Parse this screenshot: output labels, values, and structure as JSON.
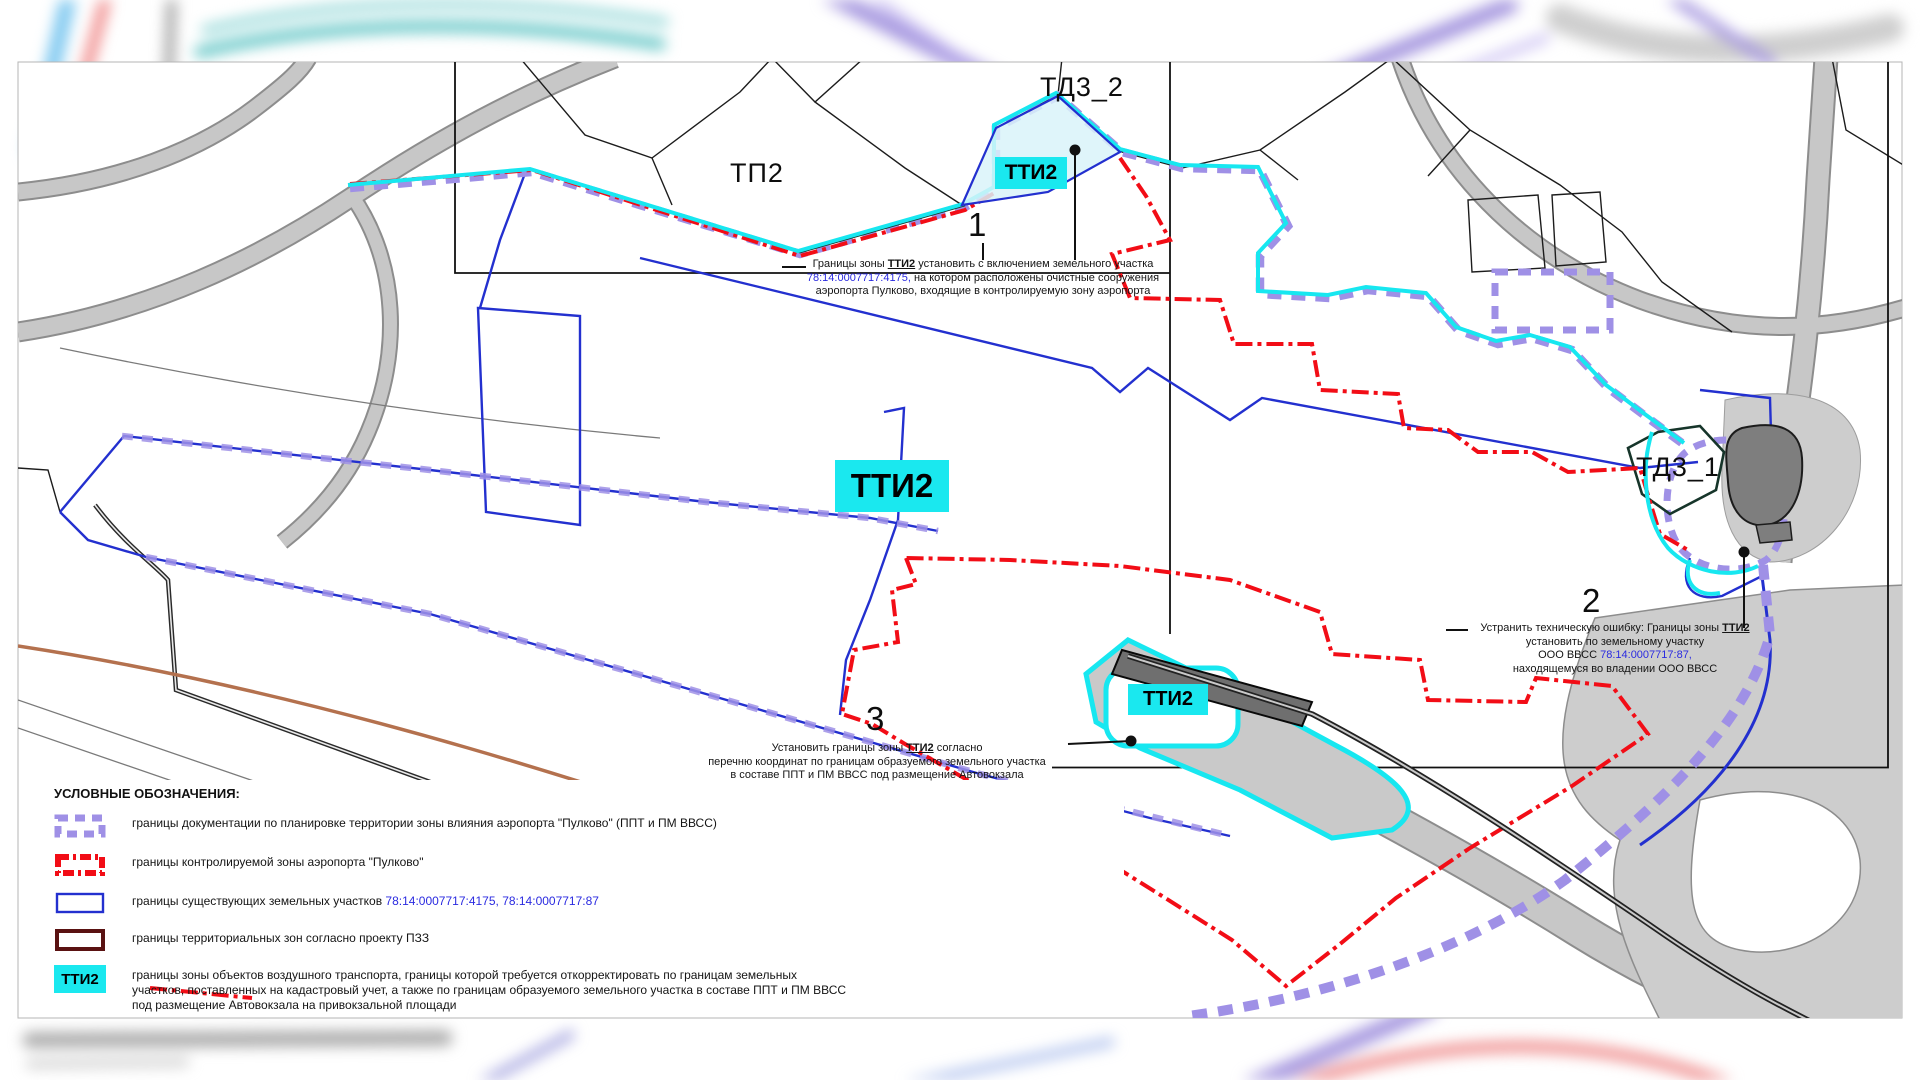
{
  "map": {
    "labels": {
      "td3_2": "ТД3_2",
      "tp2": "ТП2",
      "tti2_top": "ТТИ2",
      "tti2_center": "ТТИ2",
      "tti2_bus": "ТТИ2",
      "td3_1": "ТД3_1"
    },
    "markers": {
      "m1": "1",
      "m2": "2",
      "m3": "3"
    },
    "annotations": {
      "a1": {
        "l1_pre": "Границы зоны ",
        "l1_zone": "ТТИ2",
        "l1_post": " установить с включением земельного участка",
        "l2_num": "78:14:0007717:4175,",
        "l2_post": " на котором расположены очистные сооружения",
        "l3": "аэропорта Пулково, входящие в контролируемую зону аэропорта"
      },
      "a2": {
        "l1_pre": "Устранить техническую ошибку: Границы зоны ",
        "l1_zone": "ТТИ2",
        "l2": "установить по земельному участку",
        "l3_pre": "ООО ВВСС ",
        "l3_num": "78:14:0007717:87,",
        "l4": "находящемуся во владении ООО ВВСС"
      },
      "a3": {
        "l1_pre": "Установить границы зоны ",
        "l1_zone": "ТТИ2",
        "l1_post": " согласно",
        "l2": "перечню координат по границам образуемого земельного участка",
        "l3": "в составе ППТ и ПМ ВВСС под размещение Автовокзала"
      }
    }
  },
  "legend": {
    "title": "УСЛОВНЫЕ ОБОЗНАЧЕНИЯ:",
    "items": [
      {
        "label": "границы документации по планировке территории зоны влияния аэропорта \"Пулково\" (ППТ и ПМ ВВСС)"
      },
      {
        "label": "границы контролируемой зоны аэропорта \"Пулково\""
      },
      {
        "label_pre": "границы существующих земельных участков ",
        "label_numbers": "78:14:0007717:4175, 78:14:0007717:87"
      },
      {
        "label": "границы территориальных зон согласно проекту ПЗЗ"
      },
      {
        "swatch_text": "ТТИ2",
        "label_lines": [
          "границы зоны объектов воздушного транспорта, границы которой требуется откорректировать по границам земельных",
          "участков, поставленных на кадастровый учет, а также по границам образуемого земельного участка в составе ППТ и ПМ ВВСС",
          "под размещение Автовокзала на привокзальной площади"
        ]
      }
    ]
  },
  "colors": {
    "planning_boundary": "#9f90e6",
    "controlled_zone": "#f20d16",
    "existing_parcels": "#2330cf",
    "territorial_zones": "#5a1212",
    "tti2_zone_line": "#17e7f0",
    "tti2_fill": "#1ae8ef",
    "cadastral_number_text": "#2a2ae0"
  }
}
